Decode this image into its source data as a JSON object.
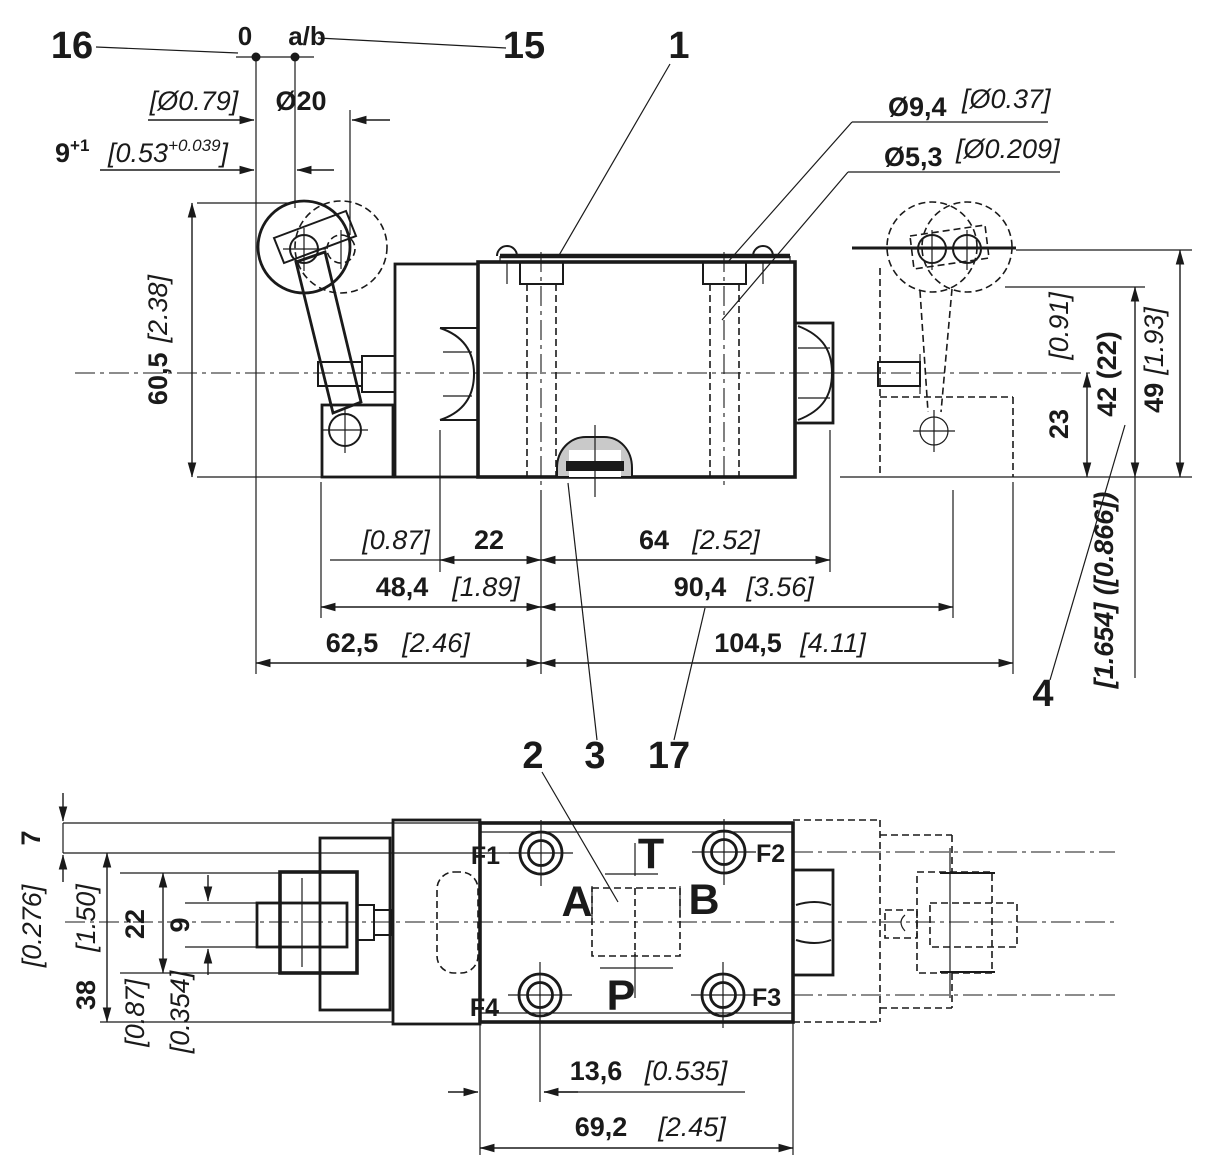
{
  "drawing": {
    "colors": {
      "line": "#1a1a1a",
      "pin_shade": "#c9c9c9",
      "background": "#ffffff"
    },
    "refs": {
      "zero": "0",
      "ab": "a/b"
    },
    "callouts": {
      "item1": "1",
      "item2": "2",
      "item3": "3",
      "item4": "4",
      "item15": "15",
      "item16": "16",
      "item17": "17"
    },
    "side_view": {
      "dims": {
        "roller_dia_in": "[Ø0.79]",
        "roller_dia_mm": "Ø20",
        "stroke_mm": "9",
        "stroke_tol": "+1",
        "stroke_in_open": "[0.53",
        "stroke_in_sup": "+0.039",
        "stroke_in_close": "]",
        "cbore_dia_mm": "Ø9,4",
        "cbore_dia_in": "[Ø0.37]",
        "hole_dia_mm": "Ø5,3",
        "hole_dia_in": "[Ø0.209]",
        "lever_height_mm": "60,5",
        "lever_height_in": "[2.38]",
        "w22_in": "[0.87]",
        "w22_mm": "22",
        "w64_mm": "64",
        "w64_in": "[2.52]",
        "w484_mm": "48,4",
        "w484_in": "[1.89]",
        "w904_mm": "90,4",
        "w904_in": "[3.56]",
        "w625_mm": "62,5",
        "w625_in": "[2.46]",
        "w1045_mm": "104,5",
        "w1045_in": "[4.11]",
        "h23_mm": "23",
        "h23_in": "[0.91]",
        "h42_mm": "42 (22)",
        "h42_in": "[1.654] ([0.866])",
        "h49_mm": "49",
        "h49_in": "[1.93]"
      }
    },
    "plan_view": {
      "dims": {
        "h7_mm": "7",
        "h7_in": "[0.276]",
        "h38_mm": "38",
        "h38_in": "[1.50]",
        "h22_mm": "22",
        "h22_in": "[0.87]",
        "h9_mm": "9",
        "h9_in": "[0.354]",
        "w136_mm": "13,6",
        "w136_in": "[0.535]",
        "w692_mm": "69,2",
        "w692_in": "[2.45]"
      },
      "ports": {
        "t": "T",
        "a": "A",
        "b": "B",
        "p": "P"
      },
      "mount_holes": {
        "f1": "F1",
        "f2": "F2",
        "f3": "F3",
        "f4": "F4"
      }
    }
  }
}
